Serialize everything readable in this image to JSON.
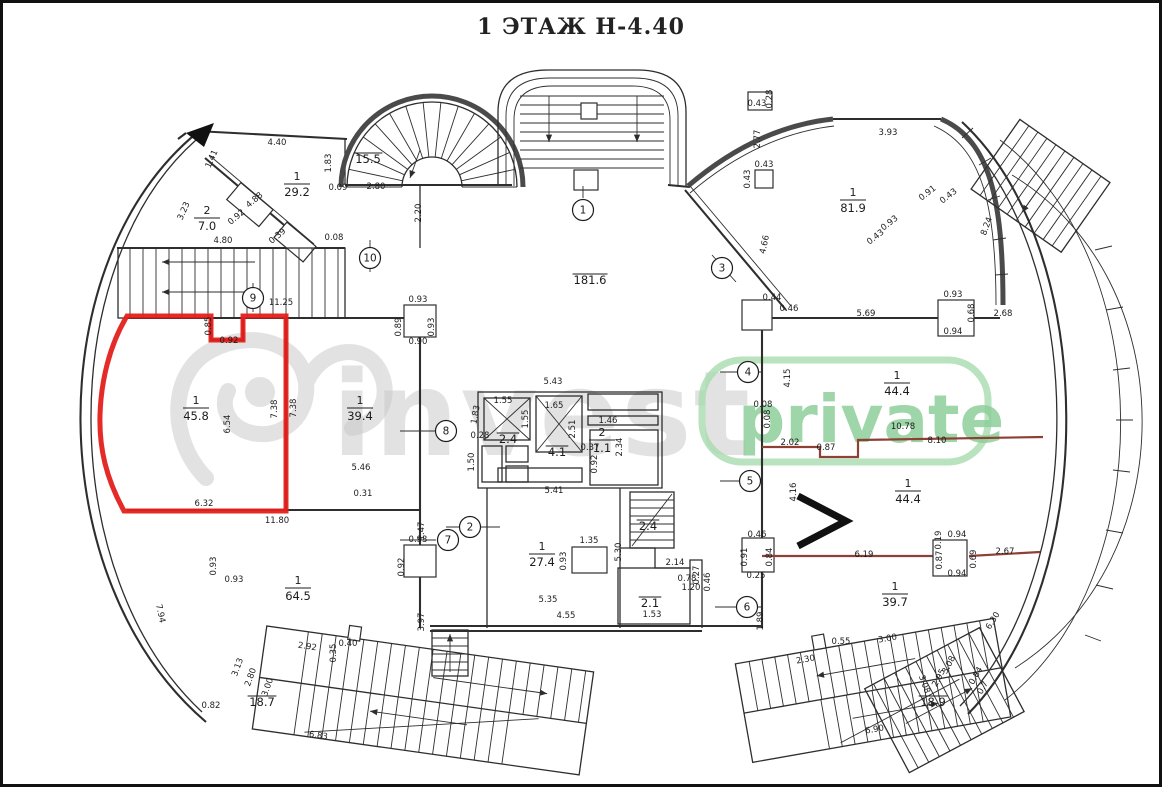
{
  "title": "1 ЭТАЖ Н-4.40",
  "watermark": {
    "logo_text": "invest",
    "badge_text": "private",
    "logo_color": "#c7c7c7",
    "badge_color": "#8fcf9b",
    "badge_border_color": "#a8dbae"
  },
  "highlight_color": "#e3201b",
  "rooms": [
    {
      "num": "1",
      "area": "29.2",
      "x": 297,
      "y": 180
    },
    {
      "num": "2",
      "area": "7.0",
      "x": 207,
      "y": 214
    },
    {
      "num": "1",
      "area": "45.8",
      "x": 196,
      "y": 404
    },
    {
      "num": "1",
      "area": "39.4",
      "x": 360,
      "y": 404
    },
    {
      "num": "1",
      "area": "81.9",
      "x": 853,
      "y": 196
    },
    {
      "num": "1",
      "area": "44.4",
      "x": 897,
      "y": 379
    },
    {
      "num": "1",
      "area": "44.4",
      "x": 908,
      "y": 487
    },
    {
      "num": "1",
      "area": "39.7",
      "x": 895,
      "y": 590
    },
    {
      "num": "1",
      "area": "64.5",
      "x": 298,
      "y": 584
    },
    {
      "num": "1",
      "area": "27.4",
      "x": 542,
      "y": 550
    },
    {
      "num": "2",
      "area": "1.1",
      "x": 602,
      "y": 436
    },
    {
      "num": "",
      "area": "15.5",
      "x": 368,
      "y": 163
    },
    {
      "num": "",
      "area": "181.6",
      "x": 590,
      "y": 284
    },
    {
      "num": "",
      "area": "2.4",
      "x": 508,
      "y": 443
    },
    {
      "num": "",
      "area": "4.1",
      "x": 557,
      "y": 456
    },
    {
      "num": "",
      "area": "2.4",
      "x": 648,
      "y": 530
    },
    {
      "num": "",
      "area": "2.1",
      "x": 650,
      "y": 607
    },
    {
      "num": "",
      "area": "18.7",
      "x": 262,
      "y": 706
    },
    {
      "num": "",
      "area": "18.9",
      "x": 933,
      "y": 706
    }
  ],
  "axis_markers": [
    {
      "n": "1",
      "x": 583,
      "y": 210
    },
    {
      "n": "2",
      "x": 470,
      "y": 527
    },
    {
      "n": "3",
      "x": 722,
      "y": 268
    },
    {
      "n": "4",
      "x": 748,
      "y": 372
    },
    {
      "n": "5",
      "x": 750,
      "y": 481
    },
    {
      "n": "6",
      "x": 747,
      "y": 607
    },
    {
      "n": "7",
      "x": 448,
      "y": 540
    },
    {
      "n": "8",
      "x": 446,
      "y": 431
    },
    {
      "n": "9",
      "x": 253,
      "y": 298
    },
    {
      "n": "10",
      "x": 370,
      "y": 258
    }
  ],
  "dimensions": [
    [
      "1.41",
      214,
      160,
      -66
    ],
    [
      "4.40",
      277,
      145,
      0
    ],
    [
      "1.83",
      331,
      163,
      -90
    ],
    [
      "3.23",
      186,
      212,
      -66
    ],
    [
      "0.92",
      238,
      219,
      -40
    ],
    [
      "4.88",
      256,
      202,
      -40
    ],
    [
      "0.39",
      279,
      238,
      -40
    ],
    [
      "0.09",
      338,
      190,
      0
    ],
    [
      "2.80",
      376,
      189,
      0
    ],
    [
      "2.20",
      421,
      213,
      -90
    ],
    [
      "0.08",
      334,
      240,
      0
    ],
    [
      "4.80",
      223,
      243,
      0
    ],
    [
      "11.25",
      281,
      305,
      0
    ],
    [
      "0.85",
      211,
      326,
      -90
    ],
    [
      "0.92",
      229,
      343,
      0
    ],
    [
      "6.54",
      230,
      424,
      -90
    ],
    [
      "7.38",
      277,
      409,
      -90
    ],
    [
      "7.38",
      296,
      408,
      -90
    ],
    [
      "6.32",
      204,
      506,
      0
    ],
    [
      "11.80",
      277,
      523,
      0
    ],
    [
      "0.93",
      418,
      302,
      0
    ],
    [
      "0.89",
      401,
      327,
      -90
    ],
    [
      "0.93",
      434,
      327,
      -90
    ],
    [
      "0.90",
      418,
      344,
      0
    ],
    [
      "5.46",
      361,
      470,
      0
    ],
    [
      "0.31",
      363,
      496,
      0
    ],
    [
      "5.43",
      553,
      384,
      0
    ],
    [
      "1.55",
      503,
      403,
      0
    ],
    [
      "1.65",
      554,
      408,
      0
    ],
    [
      "1.55",
      528,
      419,
      -90
    ],
    [
      "1.83",
      478,
      415,
      -80
    ],
    [
      "2.51",
      575,
      429,
      -90
    ],
    [
      "1.46",
      608,
      423,
      0
    ],
    [
      "2.34",
      622,
      447,
      -90
    ],
    [
      "0.37",
      590,
      450,
      0
    ],
    [
      "0.92",
      597,
      464,
      -90
    ],
    [
      "0.28",
      480,
      438,
      0
    ],
    [
      "1.50",
      474,
      462,
      -90
    ],
    [
      "5.41",
      554,
      493,
      0
    ],
    [
      "5.30",
      621,
      552,
      -90
    ],
    [
      "1.35",
      589,
      543,
      0
    ],
    [
      "0.93",
      566,
      561,
      -90
    ],
    [
      "5.35",
      548,
      602,
      0
    ],
    [
      "4.55",
      566,
      618,
      0
    ],
    [
      "2.14",
      675,
      565,
      0
    ],
    [
      "0.78",
      687,
      581,
      0
    ],
    [
      "0.27",
      699,
      575,
      -90
    ],
    [
      "1.20",
      691,
      590,
      0
    ],
    [
      "0.46",
      710,
      582,
      -90
    ],
    [
      "1.53",
      652,
      617,
      0
    ],
    [
      "0.43",
      757,
      106,
      0
    ],
    [
      "0.28",
      772,
      99,
      -90
    ],
    [
      "2.77",
      760,
      139,
      -90
    ],
    [
      "0.43",
      764,
      167,
      0
    ],
    [
      "0.43",
      750,
      179,
      -90
    ],
    [
      "4.66",
      767,
      245,
      -78
    ],
    [
      "3.93",
      888,
      135,
      0
    ],
    [
      "0.91",
      929,
      195,
      -38
    ],
    [
      "0.43",
      950,
      198,
      -38
    ],
    [
      "0.93",
      891,
      225,
      -38
    ],
    [
      "0.43",
      877,
      239,
      -38
    ],
    [
      "8.24",
      989,
      227,
      -70
    ],
    [
      "0.93",
      953,
      297,
      0
    ],
    [
      "0.68",
      974,
      313,
      -90
    ],
    [
      "0.94",
      953,
      334,
      0
    ],
    [
      "5.69",
      866,
      316,
      0
    ],
    [
      "2.68",
      1003,
      316,
      0
    ],
    [
      "0.44",
      772,
      300,
      0
    ],
    [
      "0.46",
      789,
      311,
      0
    ],
    [
      "4.15",
      790,
      378,
      -90
    ],
    [
      "0.08",
      763,
      407,
      0
    ],
    [
      "0.08",
      770,
      419,
      -90
    ],
    [
      "10.78",
      903,
      429,
      0
    ],
    [
      "8.10",
      937,
      443,
      0
    ],
    [
      "2.02",
      790,
      445,
      0
    ],
    [
      "0.87",
      826,
      450,
      0
    ],
    [
      "4.16",
      796,
      492,
      -90
    ],
    [
      "6.19",
      864,
      557,
      0
    ],
    [
      "0.94",
      957,
      537,
      0
    ],
    [
      "0.19",
      941,
      540,
      -90
    ],
    [
      "0.87",
      942,
      560,
      -90
    ],
    [
      "0.69",
      976,
      559,
      -90
    ],
    [
      "0.94",
      957,
      576,
      0
    ],
    [
      "2.67",
      1005,
      554,
      0
    ],
    [
      "0.46",
      757,
      537,
      0
    ],
    [
      "0.91",
      747,
      557,
      -90
    ],
    [
      "0.84",
      772,
      557,
      -90
    ],
    [
      "0.25",
      756,
      578,
      0
    ],
    [
      "1.89",
      763,
      621,
      -90
    ],
    [
      "6.30",
      995,
      622,
      -58
    ],
    [
      "2.30",
      806,
      662,
      -10
    ],
    [
      "0.55",
      841,
      644,
      0
    ],
    [
      "3.00",
      888,
      641,
      -10
    ],
    [
      "3.08",
      951,
      666,
      -62
    ],
    [
      "2.95",
      941,
      679,
      -62
    ],
    [
      "3.08",
      922,
      685,
      70
    ],
    [
      "0.84",
      978,
      677,
      -60
    ],
    [
      "0.7",
      985,
      689,
      -60
    ],
    [
      "6.90",
      875,
      732,
      -10
    ],
    [
      "2.92",
      307,
      649,
      8
    ],
    [
      "0.40",
      348,
      646,
      0
    ],
    [
      "0.35",
      336,
      653,
      -90
    ],
    [
      "3.00",
      270,
      688,
      -70
    ],
    [
      "2.80",
      253,
      678,
      -70
    ],
    [
      "3.13",
      240,
      668,
      -70
    ],
    [
      "6.83",
      318,
      738,
      8
    ],
    [
      "0.82",
      211,
      708,
      0
    ],
    [
      "7.94",
      158,
      614,
      78
    ],
    [
      "0.93",
      216,
      566,
      -90
    ],
    [
      "0.93",
      234,
      582,
      0
    ],
    [
      "3.97",
      424,
      622,
      -90
    ],
    [
      "1.47",
      424,
      531,
      -90
    ],
    [
      "0.93",
      418,
      542,
      0
    ],
    [
      "0.92",
      404,
      567,
      -90
    ]
  ]
}
